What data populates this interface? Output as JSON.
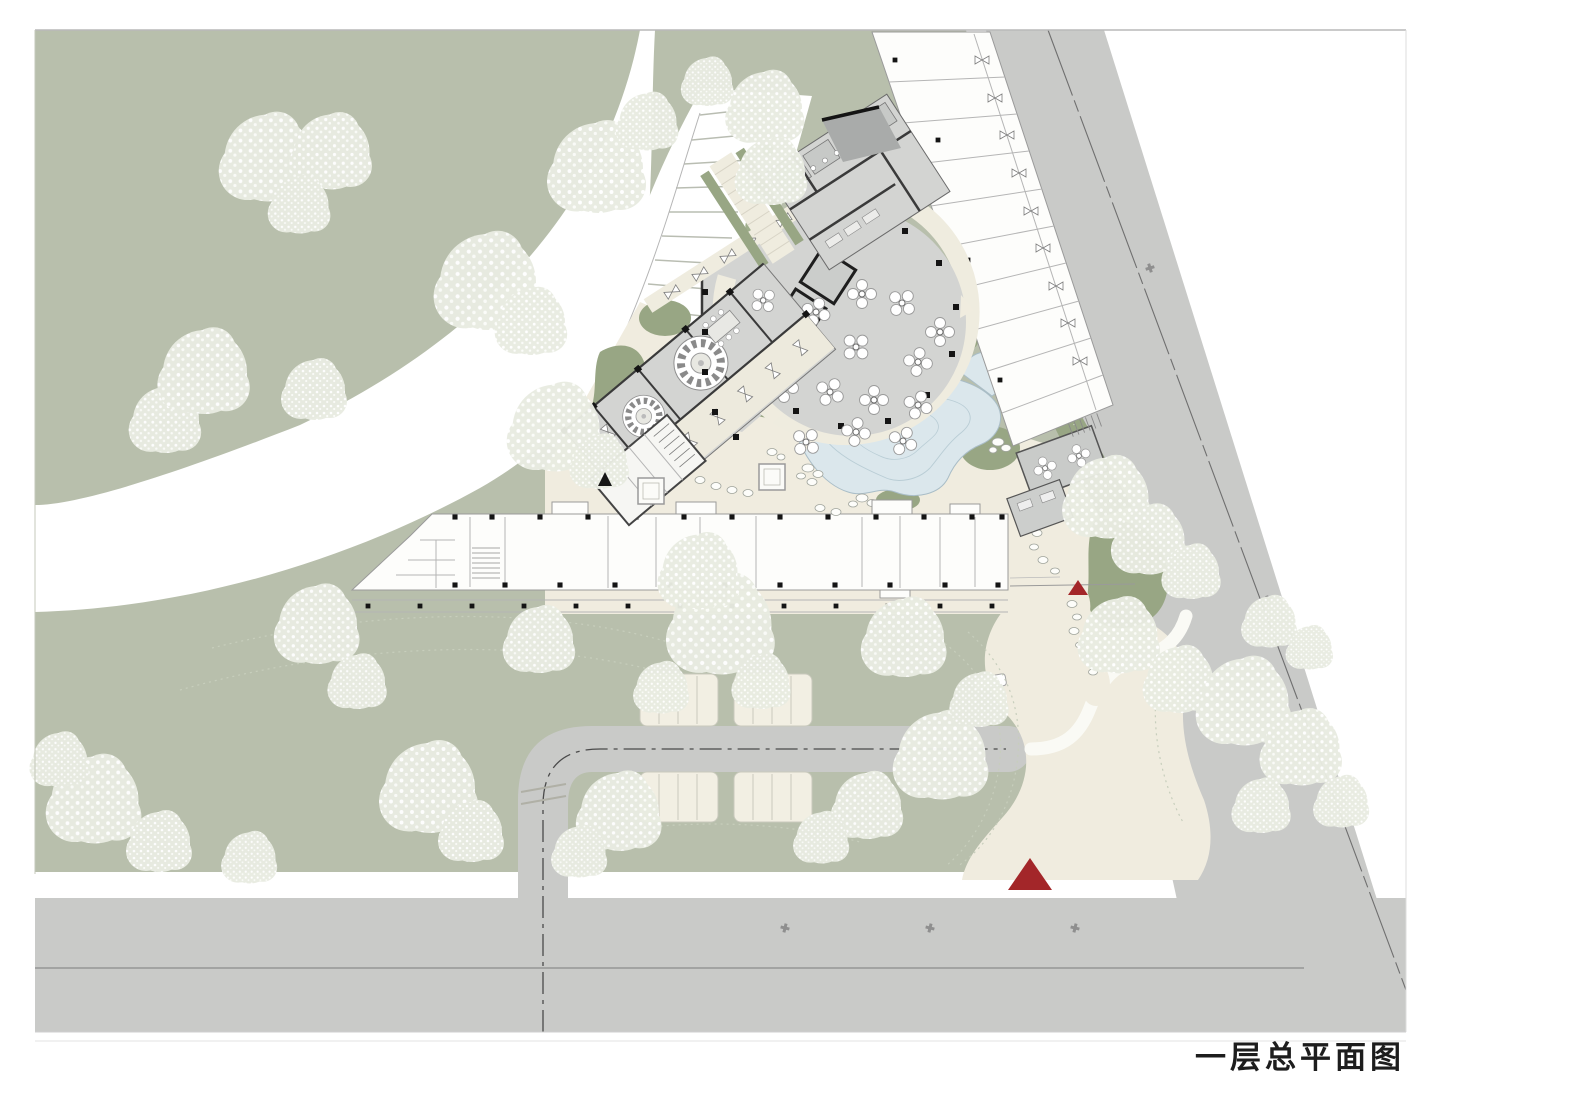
{
  "sheet": {
    "title": "一层总平面图"
  },
  "palette": {
    "page_bg": "#ffffff",
    "landscape_green": "#b8bfac",
    "landscape_green_dark": "#98a684",
    "road_grey": "#c9cac8",
    "path_cream": "#f0ecdf",
    "building_floor": "#d3d4d2",
    "building_floor_dark": "#a9abaa",
    "building_white": "#fdfdfb",
    "wall_dark": "#3a3a3a",
    "water_blue": "#dbe7ec",
    "tree_base": "#e9ece2",
    "marker_red": "#a32629",
    "centerline_grey": "#6f6f6f"
  },
  "markers": {
    "main_entrance": {
      "shape": "red-triangle",
      "color": "#a32629"
    },
    "garden_entrance": {
      "shape": "red-triangle",
      "color": "#a32629"
    },
    "service_entrance": {
      "shape": "black-triangle",
      "color": "#1a1a1a"
    }
  }
}
